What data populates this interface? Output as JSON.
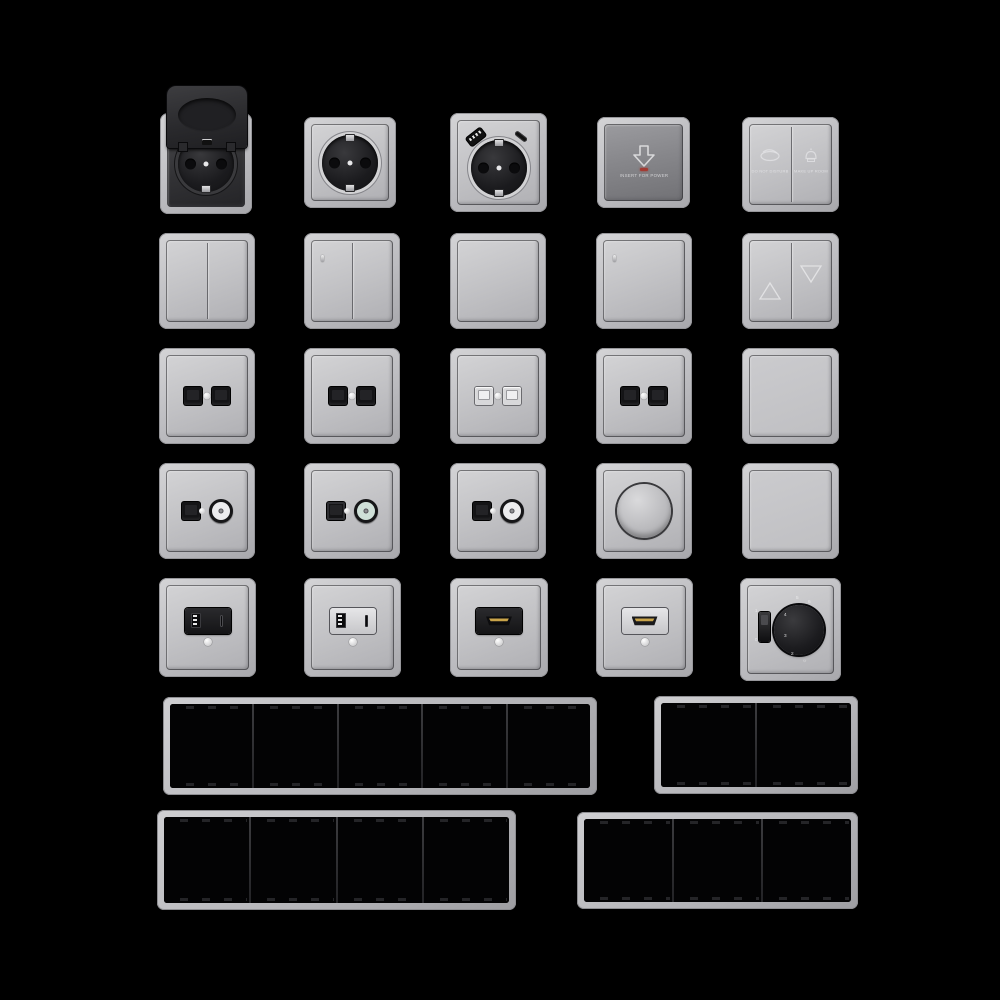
{
  "colors": {
    "background": "#000000",
    "frame_gray": "#c0c0c4",
    "plate_gray": "#c6c6c9",
    "anthracite": "#2b2b2e",
    "card_switch_metal": "#87878b",
    "led_red": "#a33b33",
    "hdmi_gold": "#c9a44a",
    "coax_green": "#cfe0d8"
  },
  "card_switch": {
    "label": "INSERT FOR POWER",
    "icon": "card-insert-down-arrow"
  },
  "hotel_switch": {
    "left_label": "do not disturb",
    "right_label": "make up room",
    "left_icon": "do-not-disturb-sign",
    "right_icon": "service-bell"
  },
  "thermostat": {
    "scale": [
      "2",
      "3",
      "4",
      "5",
      "6"
    ],
    "sun_glyph": "☼",
    "switch_marks": [
      "1",
      "0"
    ]
  },
  "items": [
    {
      "row": 1,
      "type": "schuko-socket-with-hinged-lid-anthracite"
    },
    {
      "row": 1,
      "type": "schuko-socket-gray"
    },
    {
      "row": 1,
      "type": "schuko-socket-with-usb-a-and-usb-c"
    },
    {
      "row": 1,
      "type": "key-card-power-switch"
    },
    {
      "row": 1,
      "type": "hotel-service-double-switch"
    },
    {
      "row": 2,
      "type": "double-rocker-switch"
    },
    {
      "row": 2,
      "type": "double-rocker-switch-with-indicator"
    },
    {
      "row": 2,
      "type": "single-rocker-switch"
    },
    {
      "row": 2,
      "type": "single-rocker-switch-with-indicator"
    },
    {
      "row": 2,
      "type": "shutter-switch-up-down"
    },
    {
      "row": 3,
      "type": "dual-rj45-outlet-black"
    },
    {
      "row": 3,
      "type": "dual-rj45-outlet-black"
    },
    {
      "row": 3,
      "type": "dual-data-outlet-light"
    },
    {
      "row": 3,
      "type": "dual-rj45-outlet-black"
    },
    {
      "row": 3,
      "type": "blank-rocker-plate"
    },
    {
      "row": 4,
      "type": "rj45-and-coax-outlet"
    },
    {
      "row": 4,
      "type": "data-and-coax-outlet-green-core"
    },
    {
      "row": 4,
      "type": "rj45-and-coax-outlet"
    },
    {
      "row": 4,
      "type": "rotary-dimmer"
    },
    {
      "row": 4,
      "type": "blank-cover-plate"
    },
    {
      "row": 5,
      "type": "usb-a-c-charger-black-insert"
    },
    {
      "row": 5,
      "type": "usb-a-c-charger-light-insert"
    },
    {
      "row": 5,
      "type": "hdmi-outlet-black-insert"
    },
    {
      "row": 5,
      "type": "hdmi-outlet-light-insert"
    },
    {
      "row": 5,
      "type": "thermostat-rotary-black"
    },
    {
      "row": 6,
      "type": "mounting-frame-5-gang"
    },
    {
      "row": 6,
      "type": "mounting-frame-2-gang"
    },
    {
      "row": 7,
      "type": "mounting-frame-4-gang"
    },
    {
      "row": 7,
      "type": "mounting-frame-3-gang"
    }
  ]
}
